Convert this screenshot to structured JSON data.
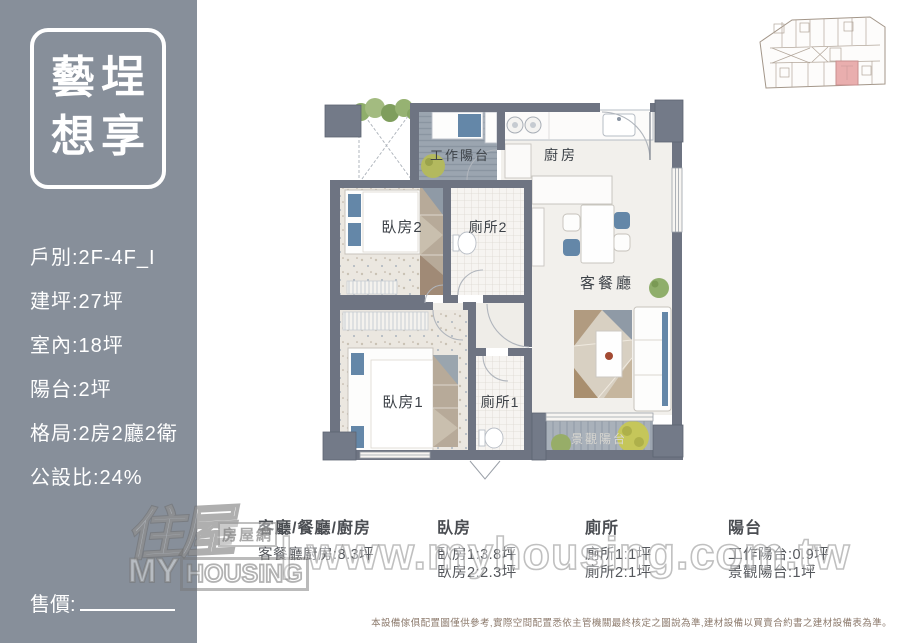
{
  "sidebar": {
    "title_line1": "藝埕",
    "title_line2": "想享",
    "details": [
      "戶別:2F-4F_I",
      "建坪:27坪",
      "室內:18坪",
      "陽台:2坪",
      "格局:2房2廳2衛",
      "公設比:24%"
    ],
    "price_label": "售價:"
  },
  "floorplan": {
    "labels": {
      "work_balcony": "工作陽台",
      "kitchen": "廚房",
      "bedroom2": "臥房2",
      "bath2": "廁所2",
      "living_dining": "客餐廳",
      "bedroom1": "臥房1",
      "bath1": "廁所1",
      "view_balcony": "景觀陽台"
    }
  },
  "legend": {
    "columns": [
      {
        "header": "客廳/餐廳/廚房",
        "rows": [
          "客餐廳廚房:8.3坪"
        ]
      },
      {
        "header": "臥房",
        "rows": [
          "臥房1:3.8坪",
          "臥房2:2.3坪"
        ]
      },
      {
        "header": "廁所",
        "rows": [
          "廁所1:1坪",
          "廁所2:1坪"
        ]
      },
      {
        "header": "陽台",
        "rows": [
          "工作陽台:0.9坪",
          "景觀陽台:1坪"
        ]
      }
    ]
  },
  "watermark": {
    "logo_chars": "住屋",
    "logo_sub": "房屋網",
    "logo_brand_a": "MY",
    "logo_brand_b": "HOUSING",
    "separator": "|",
    "url": "www.myhousing.com.tw"
  },
  "disclaimer": "本設備傢俱配置圖僅供參考,實際空間配置悉依主管機關最終核定之圖說為準,建材設備以買賣合約書之建材設備表為準。",
  "colors": {
    "sidebar_bg": "#878f9a",
    "wall": "#6e7482",
    "accent_blue": "#6487a8",
    "plant_green": "#8fae6b",
    "highlight_pink": "#e9aeae"
  }
}
